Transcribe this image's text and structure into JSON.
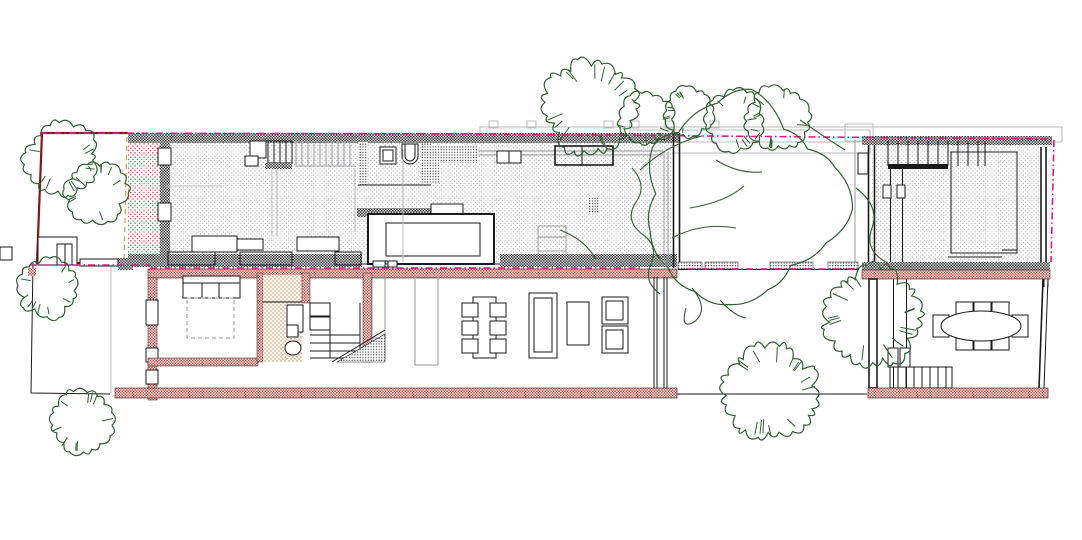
{
  "meta": {
    "title": "Row-house floor plan drawing (two stacked plans with gardens)",
    "drawing_type": "architectural plan",
    "views": [
      "upper floor plan",
      "ground floor plan"
    ]
  },
  "palette": {
    "paper": "#ffffff",
    "ink": "#1a1a1a",
    "treeGreen": "#2e6130",
    "magenta": "#e8138c",
    "maroon": "#7c1a18",
    "wallRed": "#c63a31",
    "stippleGrayDot": "#9b9fa8",
    "stippleRedDot": "#b02020",
    "stippleOrangeDot": "#c87b35",
    "denseDot": "#333333",
    "grayLine": "#9a9a9a",
    "lightGray": "#bbbbbb",
    "orangeDash": "#d59a4a"
  },
  "hatches": {
    "checker_black": "cut masonry wall (upper plan)",
    "checker_red": "cut masonry wall (ground plan)",
    "stipple_gray": "interior floor finish",
    "stipple_red": "terrace deck",
    "stipple_orange": "bathroom floor",
    "dense_dots": "partition walls / window zones"
  },
  "trees": [
    {
      "name": "tree-front-garden-1",
      "cx": 62,
      "cy": 160,
      "r": 34,
      "style": "scribble"
    },
    {
      "name": "tree-front-garden-2",
      "cx": 96,
      "cy": 192,
      "r": 29,
      "style": "scribble"
    },
    {
      "name": "tree-side-garden",
      "cx": 48,
      "cy": 287,
      "r": 29,
      "style": "scribble"
    },
    {
      "name": "tree-rear-garden-left",
      "cx": 82,
      "cy": 422,
      "r": 31,
      "style": "scribble"
    },
    {
      "name": "tree-north-row-1",
      "cx": 590,
      "cy": 107,
      "r": 44,
      "style": "scribble"
    },
    {
      "name": "tree-north-row-2",
      "cx": 646,
      "cy": 119,
      "r": 26,
      "style": "scribble"
    },
    {
      "name": "tree-north-row-3",
      "cx": 689,
      "cy": 112,
      "r": 23,
      "style": "scribble"
    },
    {
      "name": "tree-north-row-4",
      "cx": 734,
      "cy": 121,
      "r": 28,
      "style": "scribble"
    },
    {
      "name": "tree-north-row-5",
      "cx": 777,
      "cy": 119,
      "r": 30,
      "style": "scribble"
    },
    {
      "name": "tree-courtyard-large",
      "cx": 742,
      "cy": 200,
      "r": 97,
      "style": "wavy"
    },
    {
      "name": "tree-courtyard-east",
      "cx": 872,
      "cy": 317,
      "r": 46,
      "style": "scribble"
    },
    {
      "name": "tree-courtyard-south",
      "cx": 770,
      "cy": 392,
      "r": 45,
      "style": "scribble"
    }
  ],
  "inventory": {
    "upper_floor": [
      "front garden",
      "red terrace deck",
      "stair with wardrobe",
      "bathroom with wc and basin",
      "kitchen counter with double sink",
      "kitchen island",
      "two desks",
      "void with balustrade",
      "chair",
      "courtyard",
      "rear room with stair"
    ],
    "ground_floor": [
      "side garden",
      "bedroom with double bed",
      "bathroom",
      "staircase",
      "dining table with 6 chairs",
      "sofa",
      "coffee table",
      "two armchairs",
      "glazed wall to courtyard",
      "courtyard garden",
      "dining room with oval table and 8 chairs",
      "stair down"
    ]
  }
}
